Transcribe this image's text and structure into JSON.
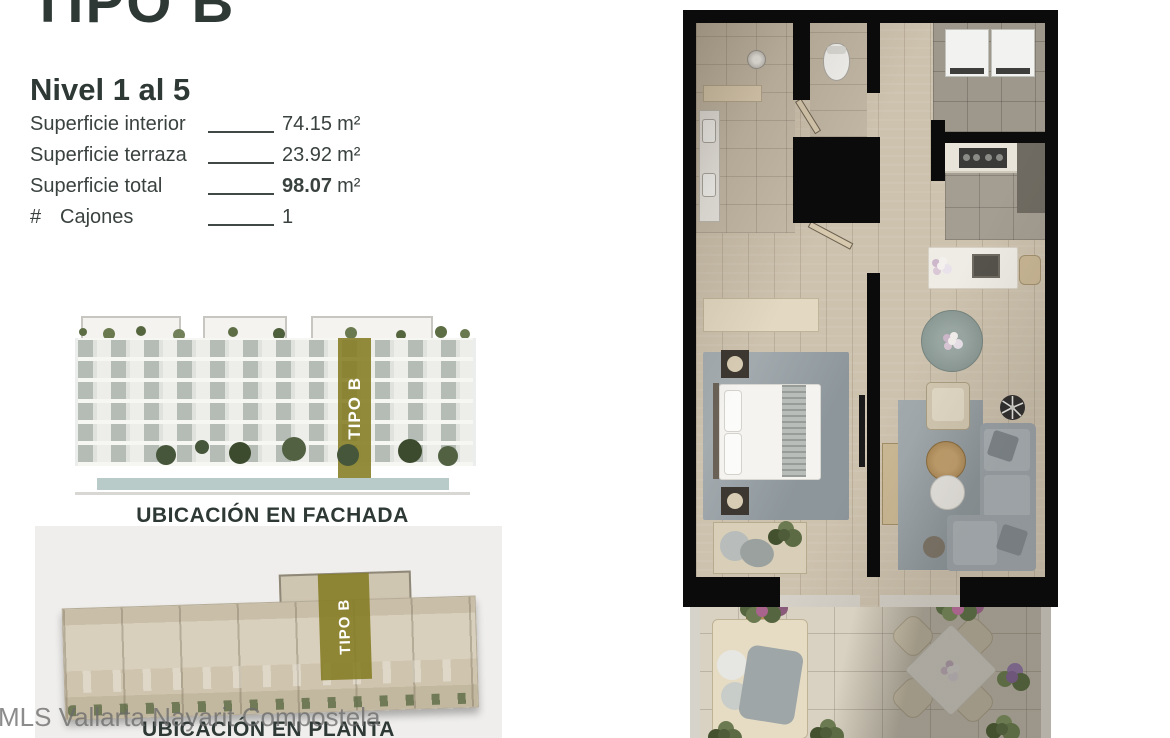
{
  "page": {
    "title": "TIPO B"
  },
  "unit": {
    "level": "Nivel 1 al 5",
    "specs": [
      {
        "label": "Superficie interior",
        "value": "74.15",
        "unit": "m²"
      },
      {
        "label": "Superficie terraza",
        "value": "23.92",
        "unit": "m²"
      },
      {
        "label": "Superficie total",
        "value": "98.07",
        "unit": "m²"
      },
      {
        "prefix": "#",
        "label": "Cajones",
        "value": "1",
        "unit": ""
      }
    ]
  },
  "highlight": {
    "label": "TIPO B",
    "color": "#847C22"
  },
  "captions": {
    "facade": "UBICACIÓN EN FACHADA",
    "plan": "UBICACIÓN EN PLANTA"
  },
  "watermark": {
    "text": "MLS Vallarta Nayarit Compostela"
  }
}
